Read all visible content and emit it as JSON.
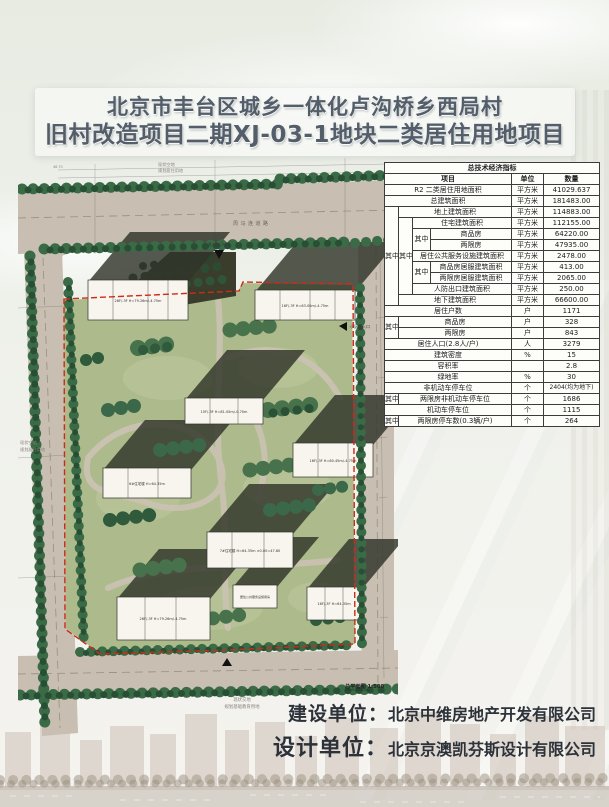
{
  "title": {
    "line1": "北京市丰台区城乡一体化卢沟桥乡西局村",
    "line2": "旧村改造项目二期XJ-03-1地块二类居住用地项目"
  },
  "table": {
    "title": "总技术经济指标",
    "headers": {
      "item": "项目",
      "unit": "单位",
      "qty": "数量"
    },
    "zhong": "其中",
    "rows": [
      {
        "item": "R2 二类居住用地面积",
        "unit": "平方米",
        "qty": "41029.637"
      },
      {
        "item": "总建筑面积",
        "unit": "平方米",
        "qty": "181483.00"
      },
      {
        "item": "地上建筑面积",
        "unit": "平方米",
        "qty": "114883.00"
      },
      {
        "item": "住宅建筑面积",
        "unit": "平方米",
        "qty": "112155.00"
      },
      {
        "item": "商品房",
        "unit": "平方米",
        "qty": "64220.00"
      },
      {
        "item": "两限房",
        "unit": "平方米",
        "qty": "47935.00"
      },
      {
        "item": "居住公共服务设施建筑面积",
        "unit": "平方米",
        "qty": "2478.00"
      },
      {
        "item": "商品房居服建筑面积",
        "unit": "平方米",
        "qty": "413.00"
      },
      {
        "item": "两限房居服建筑面积",
        "unit": "平方米",
        "qty": "2065.00"
      },
      {
        "item": "人防出口建筑面积",
        "unit": "平方米",
        "qty": "250.00"
      },
      {
        "item": "地下建筑面积",
        "unit": "平方米",
        "qty": "66600.00"
      },
      {
        "item": "居住户数",
        "unit": "户",
        "qty": "1171"
      },
      {
        "item": "商品房",
        "unit": "户",
        "qty": "328"
      },
      {
        "item": "两限房",
        "unit": "户",
        "qty": "843"
      },
      {
        "item": "居住人口(2.8人/户)",
        "unit": "人",
        "qty": "3279"
      },
      {
        "item": "建筑密度",
        "unit": "%",
        "qty": "15"
      },
      {
        "item": "容积率",
        "unit": "",
        "qty": "2.8"
      },
      {
        "item": "绿地率",
        "unit": "%",
        "qty": "30"
      },
      {
        "item": "非机动车停车位",
        "unit": "个",
        "qty": "2404(均为地下)"
      },
      {
        "item": "两限房非机动车停车位",
        "unit": "个",
        "qty": "1686"
      },
      {
        "item": "机动车停车位",
        "unit": "个",
        "qty": "1115"
      },
      {
        "item": "两限房停车数(0.3辆/户)",
        "unit": "个",
        "qty": "264"
      }
    ]
  },
  "plan": {
    "road_label": "周马连道路",
    "scale_label": "总平面图 1:500",
    "elevation_note": "46.70",
    "top_note1": "现状空地",
    "top_note2": "规划居住用地",
    "left_note1": "现状空地",
    "left_note2": "规划居住用地",
    "bottom_note1": "现状交地",
    "bottom_note2": "规划基础教育用地",
    "entrance_top": "进入口(人行)",
    "entrance_right": "小区主入口",
    "buildings": [
      {
        "label": "26F/-3F H=79.26m/-4.75m"
      },
      {
        "label": "16F/-3F H=63.00m/-4.75m"
      },
      {
        "label": "15F/-3F H=81.05m/-0.70m"
      },
      {
        "label": "6#住宅楼 H=64.35m"
      },
      {
        "label": "16F/-3F H=80.45m/-4.75m"
      },
      {
        "label": "7#住宅楼 H=64.35m ±0.00=47.60"
      },
      {
        "label": "26F/-3F H=79.26m/-4.75m"
      },
      {
        "label": "居住公共服务设施用房"
      },
      {
        "label": "16F/-3F H=64.35m"
      }
    ]
  },
  "credits": {
    "build_label": "建设单位：",
    "build_value": "北京中维房地产开发有限公司",
    "design_label": "设计单位：",
    "design_value": "北京京澳凯芬斯设计有限公司"
  },
  "colors": {
    "road_tan": "#c8beb1",
    "site_green": "#adbb8c",
    "tree_dark": "#35613f",
    "boundary_red": "#cf2a18",
    "shadow": "#31342a",
    "title_text": "#535e6a"
  }
}
